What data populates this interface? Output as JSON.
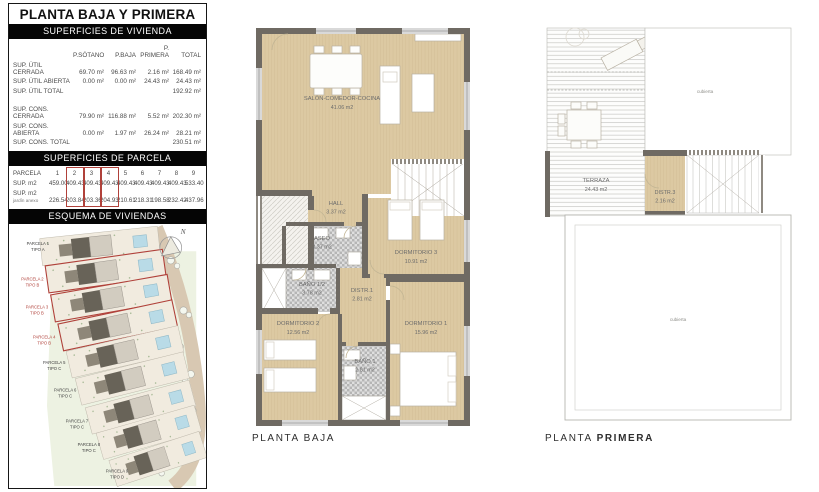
{
  "panel_left": {
    "title": "PLANTA BAJA Y PRIMERA",
    "vivienda": {
      "heading": "SUPERFICIES DE VIVIENDA",
      "columns": [
        "P.SÓTANO",
        "P.BAJA",
        "P. PRIMERA",
        "TOTAL"
      ],
      "rows": [
        {
          "label": "SUP. ÚTIL CERRADA",
          "v": [
            "69.70 m²",
            "96.63 m²",
            "2.16 m²",
            "168.49 m²"
          ]
        },
        {
          "label": "SUP. ÚTIL ABIERTA",
          "v": [
            "0.00 m²",
            "0.00 m²",
            "24.43 m²",
            "24.43 m²"
          ]
        },
        {
          "label": "SUP. ÚTIL TOTAL",
          "v": [
            "",
            "",
            "",
            "192.92 m²"
          ]
        },
        {
          "label": "SUP. CONS. CERRADA",
          "v": [
            "79.90 m²",
            "116.88 m²",
            "5.52 m²",
            "202.30 m²"
          ]
        },
        {
          "label": "SUP. CONS. ABIERTA",
          "v": [
            "0.00 m²",
            "1.97 m²",
            "26.24 m²",
            "28.21 m²"
          ]
        },
        {
          "label": "SUP. CONS. TOTAL",
          "v": [
            "",
            "",
            "",
            "230.51 m²"
          ]
        }
      ]
    },
    "parcela": {
      "heading": "SUPERFICIES DE PARCELA",
      "row1_label": "PARCELA",
      "row2_label": "SUP. m2",
      "row3_label": "SUP. m2",
      "row3_sublabel": "jardín anexo",
      "numbers": [
        "1",
        "2",
        "3",
        "4",
        "5",
        "6",
        "7",
        "8",
        "9"
      ],
      "sup": [
        "459.00",
        "409.43",
        "409.43",
        "409.43",
        "409.43",
        "409.43",
        "409.43",
        "409.43",
        "533.40"
      ],
      "jardin": [
        "226.54",
        "203.84",
        "203.36",
        "204.93",
        "210.61",
        "218.31",
        "198.58",
        "232.42",
        "437.96"
      ],
      "highlighted_parcels": [
        "2",
        "3",
        "4"
      ]
    },
    "esquema": {
      "heading": "ESQUEMA DE VIVIENDAS",
      "north": "N",
      "parcels": [
        {
          "name": "PARCELA 1",
          "tipo": "TIPO A",
          "highlighted": false
        },
        {
          "name": "PARCELA 2",
          "tipo": "TIPO B",
          "highlighted": true
        },
        {
          "name": "PARCELA 3",
          "tipo": "TIPO B",
          "highlighted": true
        },
        {
          "name": "PARCELA 4",
          "tipo": "TIPO B",
          "highlighted": true
        },
        {
          "name": "PARCELA 5",
          "tipo": "TIPO C",
          "highlighted": false
        },
        {
          "name": "PARCELA 6",
          "tipo": "TIPO C",
          "highlighted": false
        },
        {
          "name": "PARCELA 7",
          "tipo": "TIPO C",
          "highlighted": false
        },
        {
          "name": "PARCELA 8",
          "tipo": "TIPO C",
          "highlighted": false
        },
        {
          "name": "PARCELA 9",
          "tipo": "TIPO D",
          "highlighted": false
        }
      ]
    }
  },
  "plan_baja": {
    "caption": "PLANTA BAJA",
    "rooms": {
      "salon": {
        "name": "SALÓN-COMEDOR-COCINA",
        "area": "41.06 m2"
      },
      "hall": {
        "name": "HALL",
        "area": "3.37 m2"
      },
      "aseo": {
        "name": "ASEO",
        "area": "3.37 m2"
      },
      "bano_medio": {
        "name": "BAÑO 1/2",
        "area": "3.78 m2"
      },
      "distr1": {
        "name": "DISTR.1",
        "area": "2.81 m2"
      },
      "dorm3": {
        "name": "DORMITORIO 3",
        "area": "10.91 m2"
      },
      "dorm2": {
        "name": "DORMITORIO 2",
        "area": "12.56 m2"
      },
      "dorm1": {
        "name": "DORMITORIO 1",
        "area": "15.96 m2"
      },
      "bano1": {
        "name": "BAÑO 1",
        "area": "2.81 m2"
      }
    }
  },
  "plan_primera": {
    "caption_regular": "PLANTA ",
    "caption_bold": "PRIMERA",
    "roof_label": "cubierta",
    "rooms": {
      "terraza": {
        "name": "TERRAZA",
        "area": "24.43 m2"
      },
      "distr3": {
        "name": "DISTR.3",
        "area": "2.16 m2"
      }
    }
  },
  "colors": {
    "accent_red": "#b0413a",
    "floor_beige": "#dcc9a2",
    "wall_gray": "#6f6a63",
    "pool_blue": "#b9dbe7",
    "site_green": "#edf2e2"
  }
}
